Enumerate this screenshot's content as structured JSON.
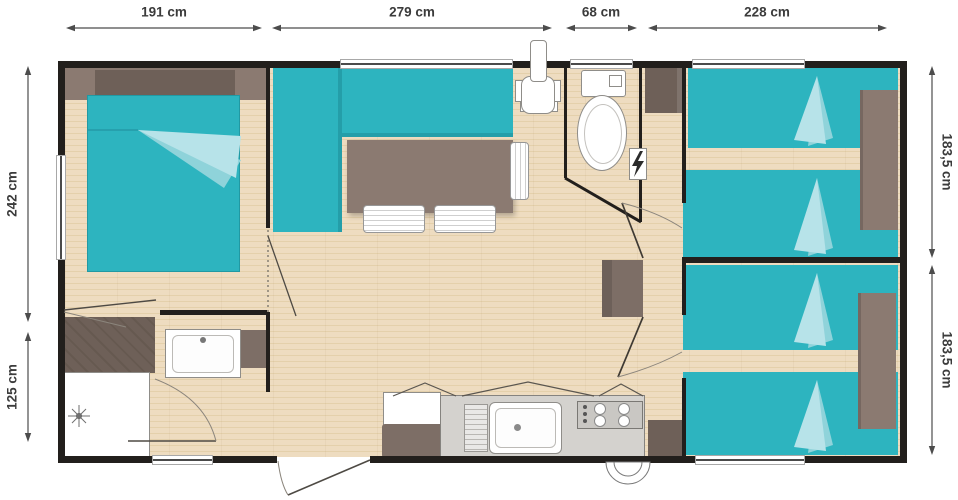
{
  "plan": {
    "dimensions": {
      "top": [
        "191 cm",
        "279 cm",
        "68 cm",
        "228 cm"
      ],
      "left": [
        "242 cm",
        "125 cm"
      ],
      "right": [
        "183,5 cm",
        "183,5 cm"
      ]
    },
    "colors": {
      "wall": "#221f1c",
      "floor_wood": "#ecdabb",
      "furniture_teal": "#2db4bf",
      "furniture_brown": "#8b7a71",
      "fold_light_blue": "#b7e3e9",
      "fixture_white": "#ffffff",
      "dimension_text": "#3b3b3b"
    }
  }
}
